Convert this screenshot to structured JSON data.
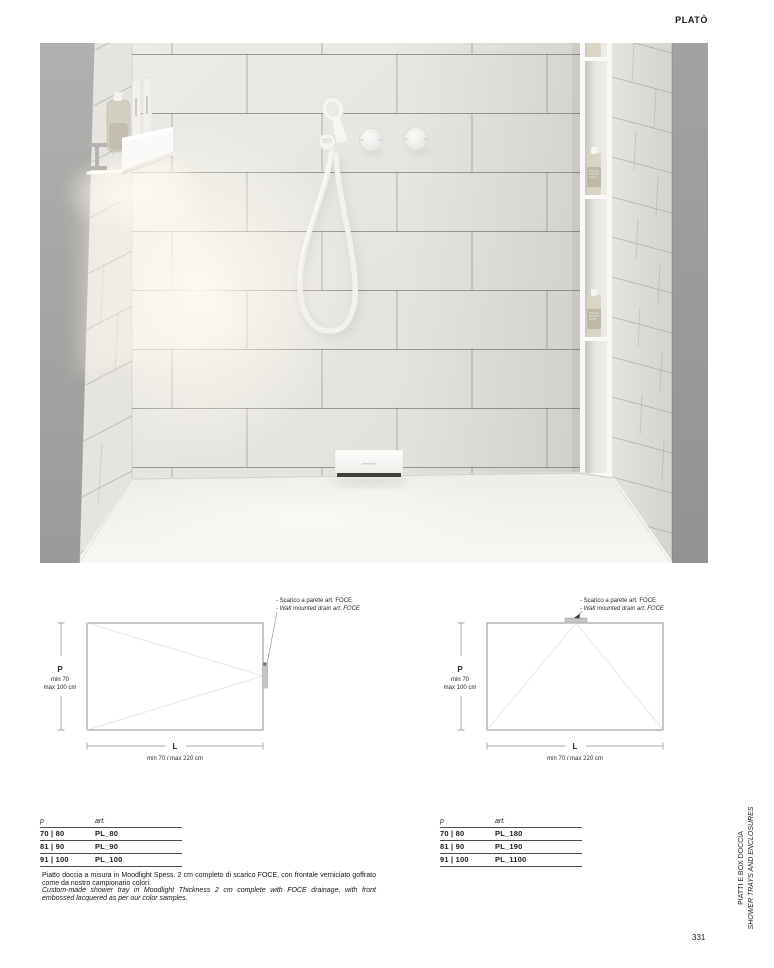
{
  "page": {
    "header": "PLATÒ",
    "number": "331"
  },
  "sidebar": {
    "it": "PIATTI E BOX DOCCIA",
    "en": "SHOWER TRAYS AND ENCLOSURES"
  },
  "diagrams": [
    {
      "annotation_it": "- Scarico a parete art. FOCE",
      "annotation_en": "- Wall mounted drain art. FOCE",
      "p_label": "P",
      "p_min": "min 70",
      "p_max": "max 100 cm",
      "l_label": "L",
      "l_range": "min 70 / max 220 cm",
      "drain_position": "right-center"
    },
    {
      "annotation_it": "- Scarico a parete art. FOCE",
      "annotation_en": "- Wall mounted drain art. FOCE",
      "p_label": "P",
      "p_min": "min 70",
      "p_max": "max 100 cm",
      "l_label": "L",
      "l_range": "min 70 / max 220 cm",
      "drain_position": "top-center"
    }
  ],
  "tables": [
    {
      "header_p": "p",
      "header_art": "art.",
      "rows": [
        {
          "p": "70 | 80",
          "art": "PL_80"
        },
        {
          "p": "81 | 90",
          "art": "PL_90"
        },
        {
          "p": "91 | 100",
          "art": "PL_100"
        }
      ]
    },
    {
      "header_p": "p",
      "header_art": "art.",
      "rows": [
        {
          "p": "70 | 80",
          "art": "PL_180"
        },
        {
          "p": "81 | 90",
          "art": "PL_190"
        },
        {
          "p": "91 | 100",
          "art": "PL_1100"
        }
      ]
    }
  ],
  "description": {
    "it": "Piatto doccia a misura in Moodlight Spess. 2 cm completo di scarico FOCE, con frontale verniciato goffrato come da nostro campionario colori.",
    "en": "Custom-made shower tray in Moodlight Thickness 2 cm complete with FOCE drainage, with front embossed lacquered as per our color samples."
  },
  "colors": {
    "paper": "#ffffff",
    "text": "#1b1b1b",
    "left_wall_gray": "#a9a8a6",
    "right_wall_gray": "#9e9d9b",
    "tile": "#e9e7e2",
    "floor": "#f6f4f0"
  }
}
